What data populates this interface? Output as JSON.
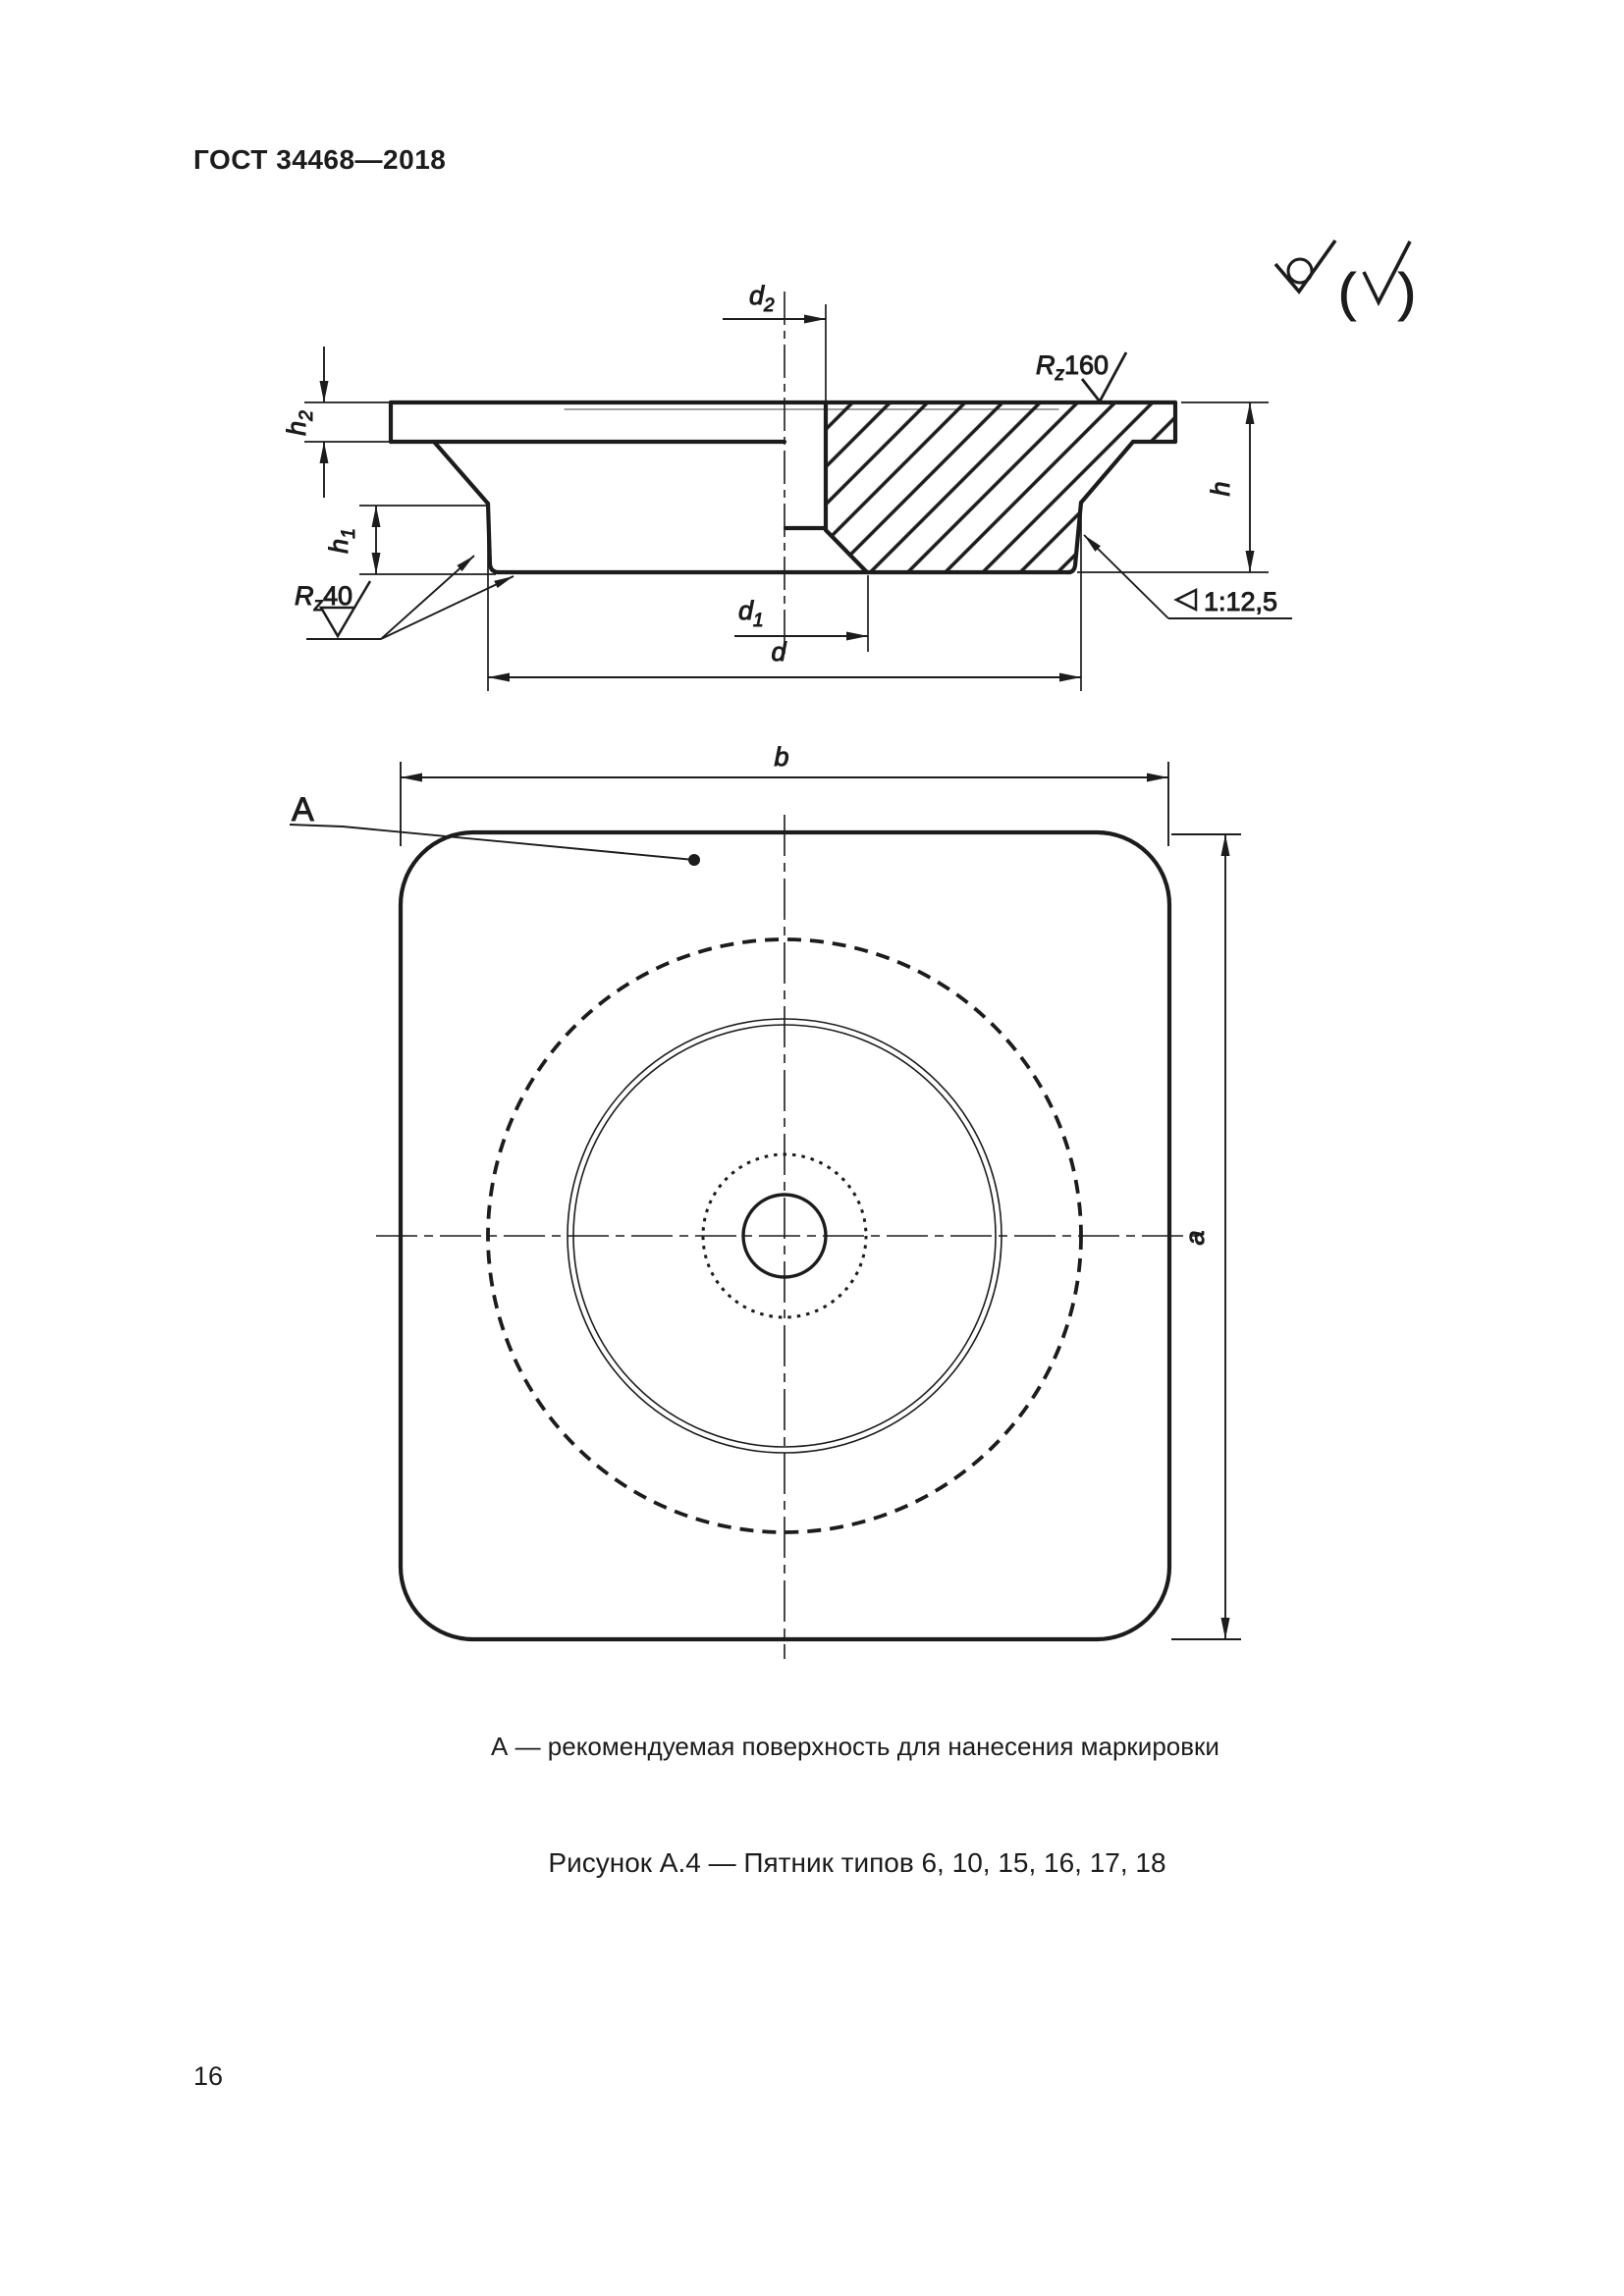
{
  "page": {
    "header": "ГОСТ 34468—2018",
    "number": "16"
  },
  "figure": {
    "note": "А — рекомендуемая поверхность для нанесения маркировки",
    "title": "Рисунок А.4 — Пятник типов 6, 10, 15, 16, 17, 18"
  },
  "dims": {
    "d2_base": "d",
    "d2_sub": "2",
    "d1_base": "d",
    "d1_sub": "1",
    "d": "d",
    "b": "b",
    "a": "a",
    "h": "h",
    "h1_base": "h",
    "h1_sub": "1",
    "h2_base": "h",
    "h2_sub": "2",
    "taper": "1:12,5"
  },
  "surface": {
    "rz160_base": "R",
    "rz160_sub": "z",
    "rz160_value": "160",
    "rz40_base": "R",
    "rz40_sub": "z",
    "rz40_value": "40"
  },
  "annotations": {
    "marking_surface_label": "A"
  },
  "symbols": {
    "paren_open": "(",
    "paren_close": ")"
  }
}
